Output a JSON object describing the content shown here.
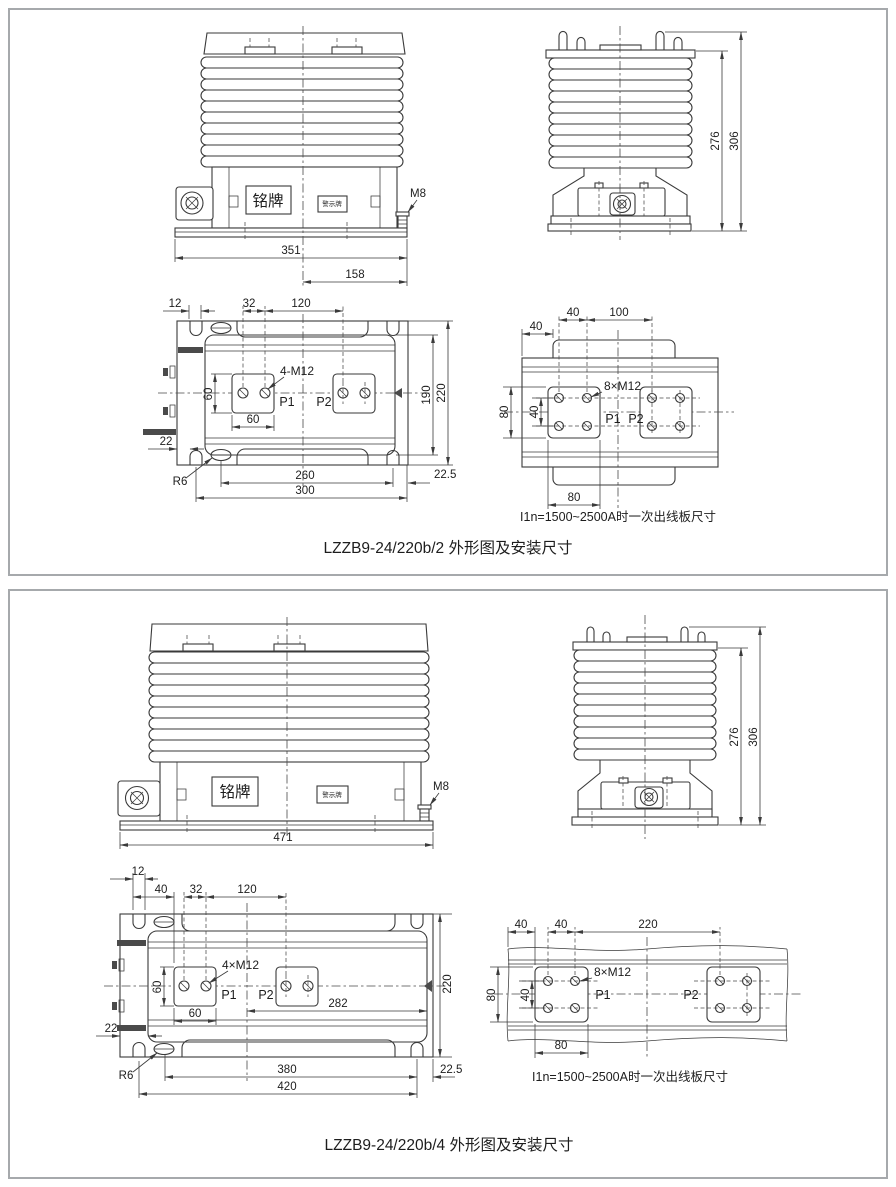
{
  "panel1": {
    "caption": "LZZB9-24/220b/2 外形图及安装尺寸",
    "front": {
      "nameplate": "铭牌",
      "warning": "警示牌",
      "bolt": "M8",
      "dim_width": "351",
      "dim_half": "158"
    },
    "side": {
      "dim_body": "276",
      "dim_total": "306"
    },
    "plan": {
      "dim_slot": "12",
      "dim_pitch32": "32",
      "dim_pitch120": "120",
      "thread": "4-M12",
      "dim_pad_h": "60",
      "dim_pad_w": "60",
      "label_p1": "P1",
      "label_p2": "P2",
      "dim_inner": "190",
      "dim_height": "220",
      "dim_edge": "22",
      "fillet": "R6",
      "dim_span": "260",
      "dim_width": "300",
      "dim_offset": "22.5"
    },
    "detail": {
      "dim_edge": "40",
      "dim_pitch": "40",
      "dim_span_x": "100",
      "dim_pad_v": "80",
      "dim_pitch_v": "40",
      "thread": "8×M12",
      "label_p1": "P1",
      "label_p2": "P2",
      "dim_pad_w": "80",
      "note": "I1n=1500~2500A时一次出线板尺寸"
    }
  },
  "panel2": {
    "caption": "LZZB9-24/220b/4 外形图及安装尺寸",
    "front": {
      "nameplate": "铭牌",
      "warning": "警示牌",
      "bolt": "M8",
      "dim_width": "471"
    },
    "side": {
      "dim_body": "276",
      "dim_total": "306"
    },
    "plan": {
      "dim_slot": "12",
      "dim_40": "40",
      "dim_pitch32": "32",
      "dim_pitch120": "120",
      "thread": "4×M12",
      "dim_pad_h": "60",
      "dim_pad_w": "60",
      "label_p1": "P1",
      "label_p2": "P2",
      "dim_center": "282",
      "dim_height": "220",
      "dim_edge": "22",
      "fillet": "R6",
      "dim_span": "380",
      "dim_width": "420",
      "dim_offset": "22.5"
    },
    "detail": {
      "dim_edge": "40",
      "dim_pitch": "40",
      "dim_span_x": "220",
      "dim_pad_v": "80",
      "dim_pitch_v": "40",
      "thread": "8×M12",
      "label_p1": "P1",
      "label_p2": "P2",
      "dim_pad_w": "80",
      "note": "I1n=1500~2500A时一次出线板尺寸"
    }
  }
}
